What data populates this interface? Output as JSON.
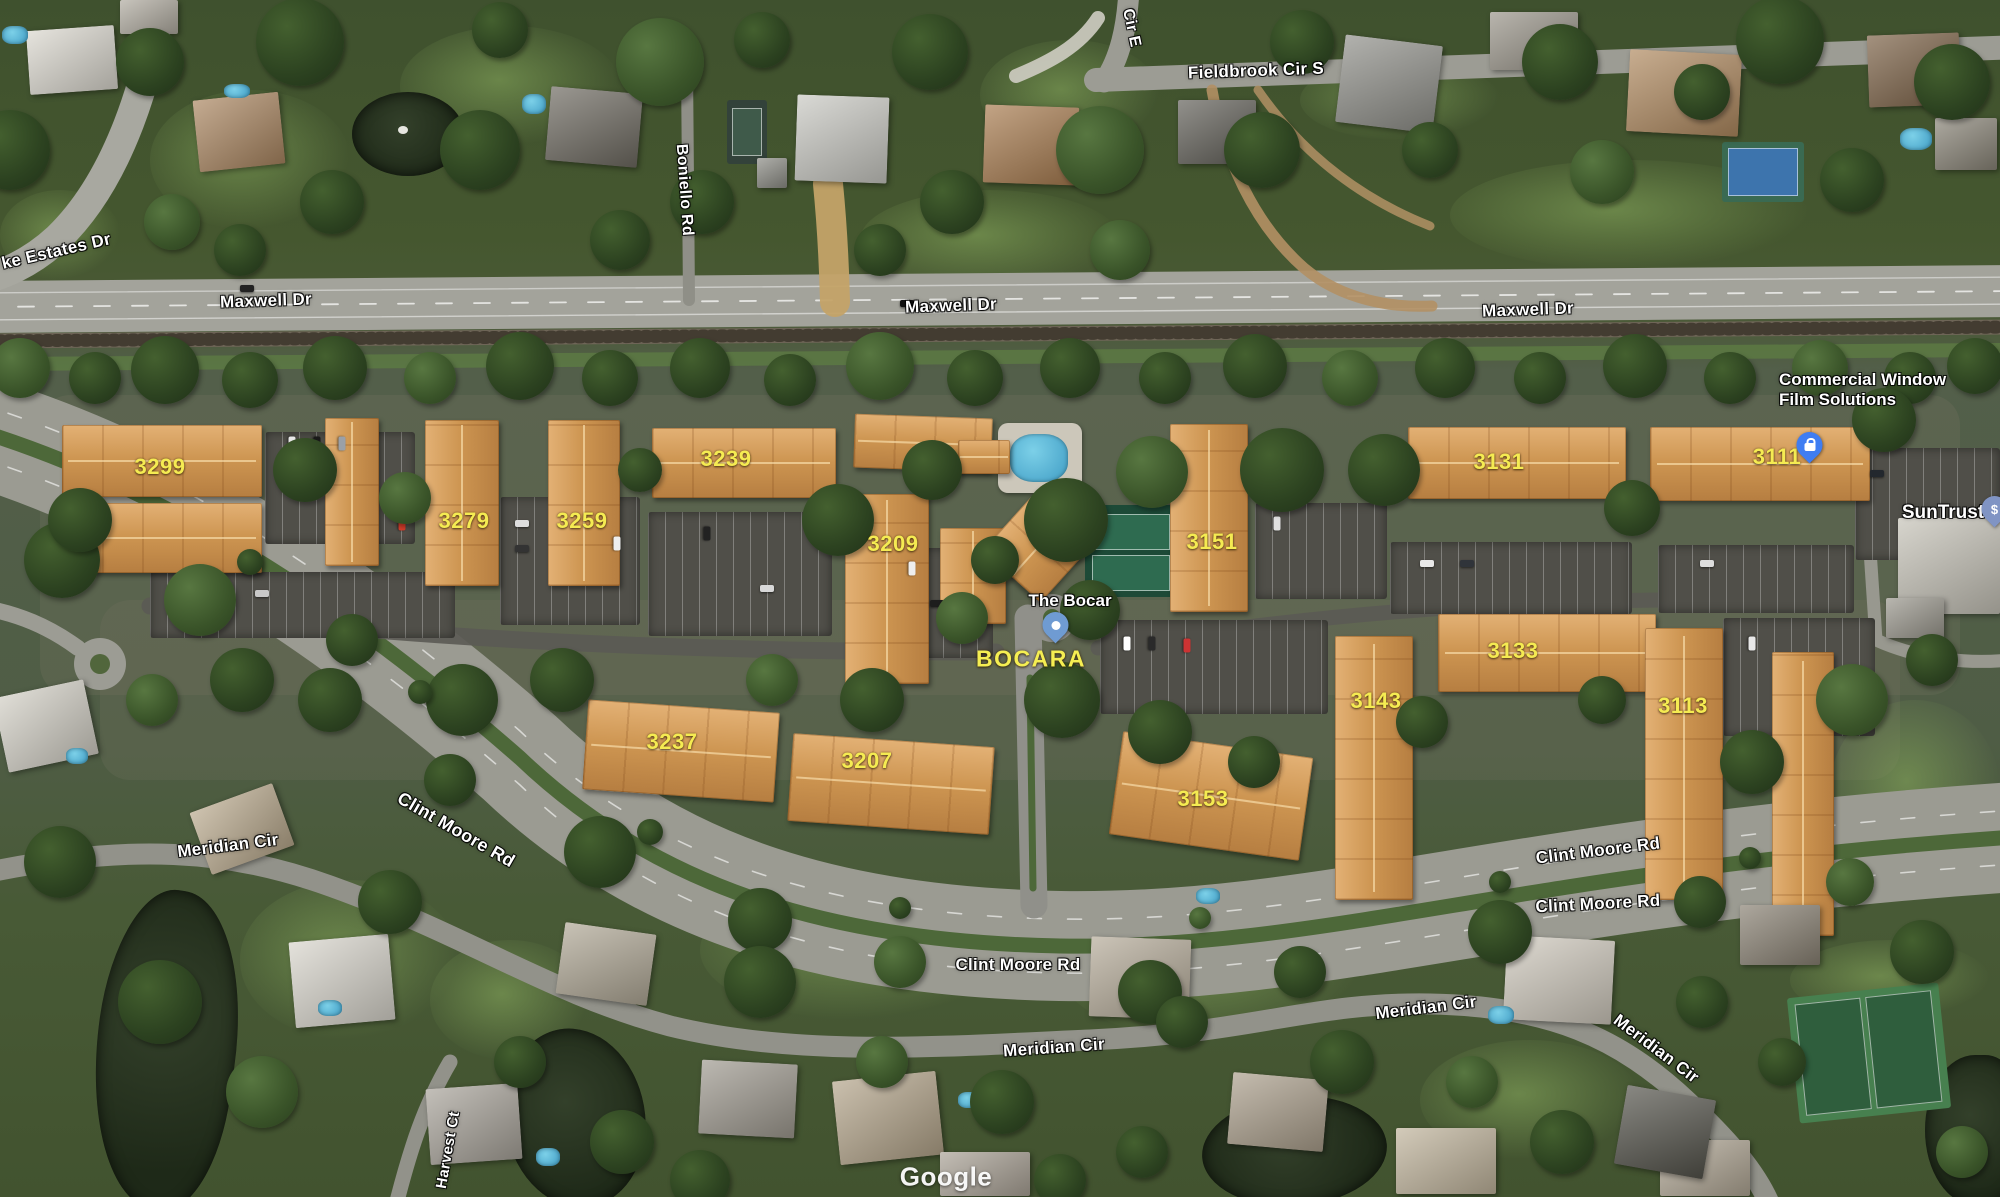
{
  "map": {
    "road_labels": [
      {
        "text": "ke Estates Dr"
      },
      {
        "text": "Maxwell Dr"
      },
      {
        "text": "Maxwell Dr"
      },
      {
        "text": "Maxwell Dr"
      },
      {
        "text": "Fieldbrook Cir S"
      },
      {
        "text": "Cir E"
      },
      {
        "text": "Boniello Rd"
      },
      {
        "text": "Clint Moore Rd"
      },
      {
        "text": "Clint Moore Rd"
      },
      {
        "text": "Clint Moore Rd"
      },
      {
        "text": "Clint Moore Rd"
      },
      {
        "text": "Meridian Cir"
      },
      {
        "text": "Meridian Cir"
      },
      {
        "text": "Meridian Cir"
      },
      {
        "text": "Meridian Cir"
      },
      {
        "text": "Harvest Ct"
      }
    ],
    "building_labels": [
      {
        "text": "3299"
      },
      {
        "text": "3279"
      },
      {
        "text": "3259"
      },
      {
        "text": "3239"
      },
      {
        "text": "3209"
      },
      {
        "text": "3237"
      },
      {
        "text": "3207"
      },
      {
        "text": "3151"
      },
      {
        "text": "3153"
      },
      {
        "text": "3143"
      },
      {
        "text": "3131"
      },
      {
        "text": "3133"
      },
      {
        "text": "3113"
      },
      {
        "text": "3111"
      }
    ],
    "poi_labels": {
      "complex_name": "BOCARA",
      "place": "The Bocar",
      "business_line1": "Commercial Window",
      "business_line2": "Film Solutions",
      "bank": "SunTrust"
    },
    "pins": {
      "bank_symbol": "$"
    },
    "attribution": "Google",
    "colors": {
      "building_label": "#f5eb52",
      "road_label": "#ffffff",
      "poi_label": "#ffffff",
      "pin_business": "#3f7df2",
      "pin_place": "#6f9bd2",
      "pin_bank": "#8094c4"
    }
  }
}
